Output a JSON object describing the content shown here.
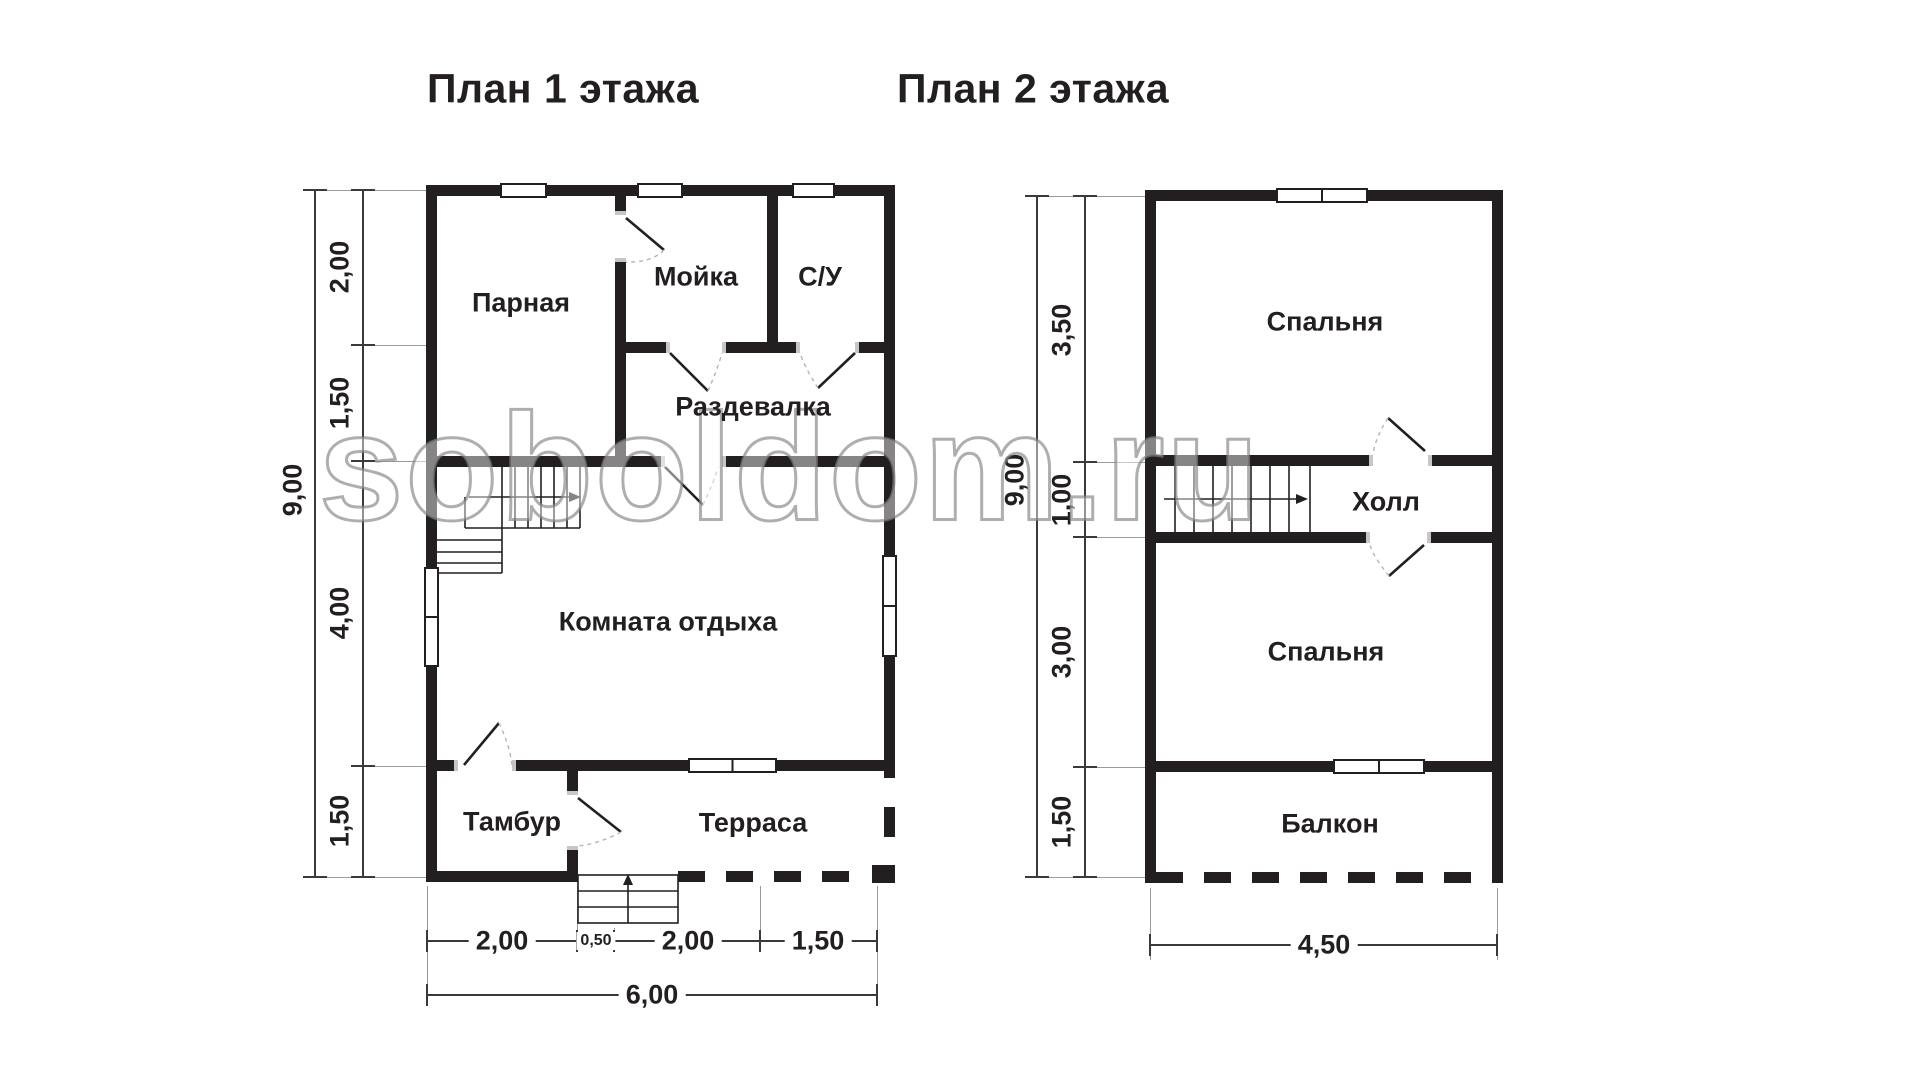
{
  "watermark": {
    "text": "soboldom.ru"
  },
  "colors": {
    "wall": "#231f20",
    "dim_line": "#3a3a3a",
    "extension_line": "#9a9a9a",
    "door_arc": "#b5b5b5",
    "wall_end_cap": "#c6c6c6",
    "background": "#ffffff"
  },
  "floor1": {
    "title": "План 1 этажа",
    "rooms": {
      "parnaya": "Парная",
      "moyka": "Мойка",
      "su": "С/У",
      "razdevalka": "Раздевалка",
      "komnata": "Комната отдыха",
      "tambur": "Тамбур",
      "terrasa": "Терраса"
    },
    "dims": {
      "left": [
        "2,00",
        "1,50",
        "4,00",
        "1,50"
      ],
      "left_total": "9,00",
      "bottom": [
        "2,00",
        "0,50",
        "2,00",
        "1,50"
      ],
      "bottom_total": "6,00"
    }
  },
  "floor2": {
    "title": "План 2 этажа",
    "rooms": {
      "bedroom_top": "Спальня",
      "hall": "Холл",
      "bedroom_bottom": "Спальня",
      "balkon": "Балкон"
    },
    "dims": {
      "left": [
        "3,50",
        "1,00",
        "3,00",
        "1,50"
      ],
      "left_total": "9,00",
      "bottom_total": "4,50"
    }
  }
}
